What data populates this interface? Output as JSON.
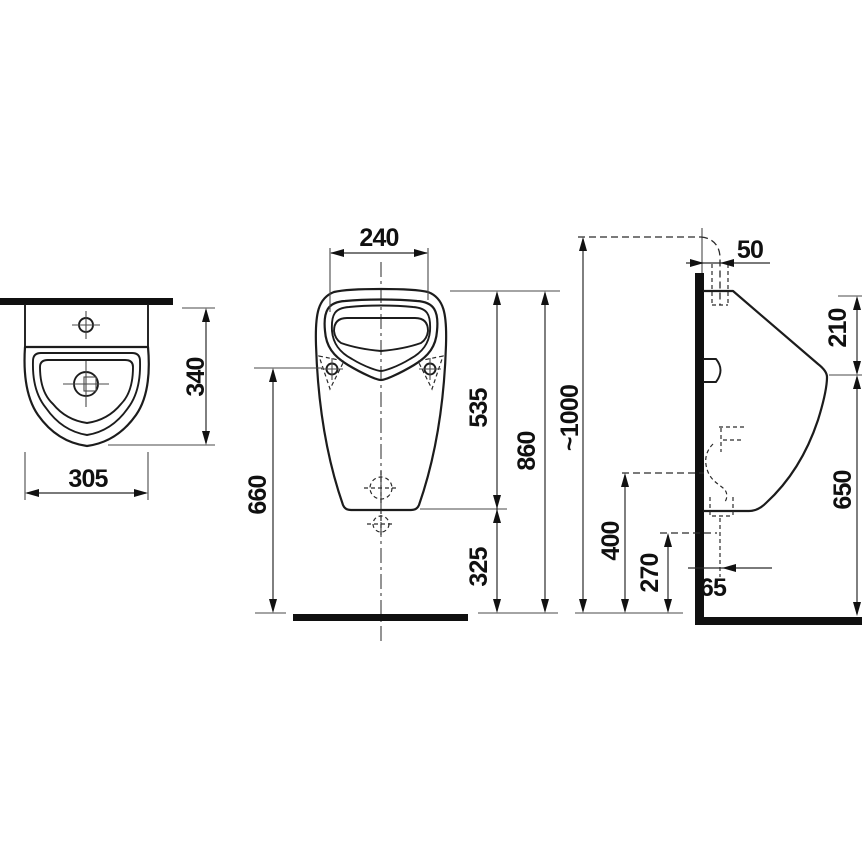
{
  "drawing": {
    "type": "technical-dimension-drawing",
    "subject": "wall-hung urinal, three orthographic views with millimetre dimensions",
    "colors": {
      "background": "#ffffff",
      "outline": "#1c1c1c",
      "dimension_line": "#2b2b2b",
      "section_fill": "#101010"
    },
    "top_view": {
      "name": "plan view",
      "dims": {
        "depth": "340",
        "width": "305"
      }
    },
    "front_view": {
      "name": "front view",
      "dims": {
        "rim_top_width": "240",
        "mount_hole_to_floor": "660",
        "rim_to_body_bottom": "535",
        "body_bottom_to_floor": "325",
        "rim_to_floor": "860",
        "inlet_to_floor": "~1000"
      }
    },
    "side_view": {
      "name": "side view",
      "dims": {
        "inlet_offset_from_wall": "50",
        "top_to_front_edge": "210",
        "front_edge_to_floor": "650",
        "outlet_upper_to_floor": "400",
        "outlet_lower_to_floor": "270",
        "outlet_offset_from_wall": "65"
      }
    }
  }
}
